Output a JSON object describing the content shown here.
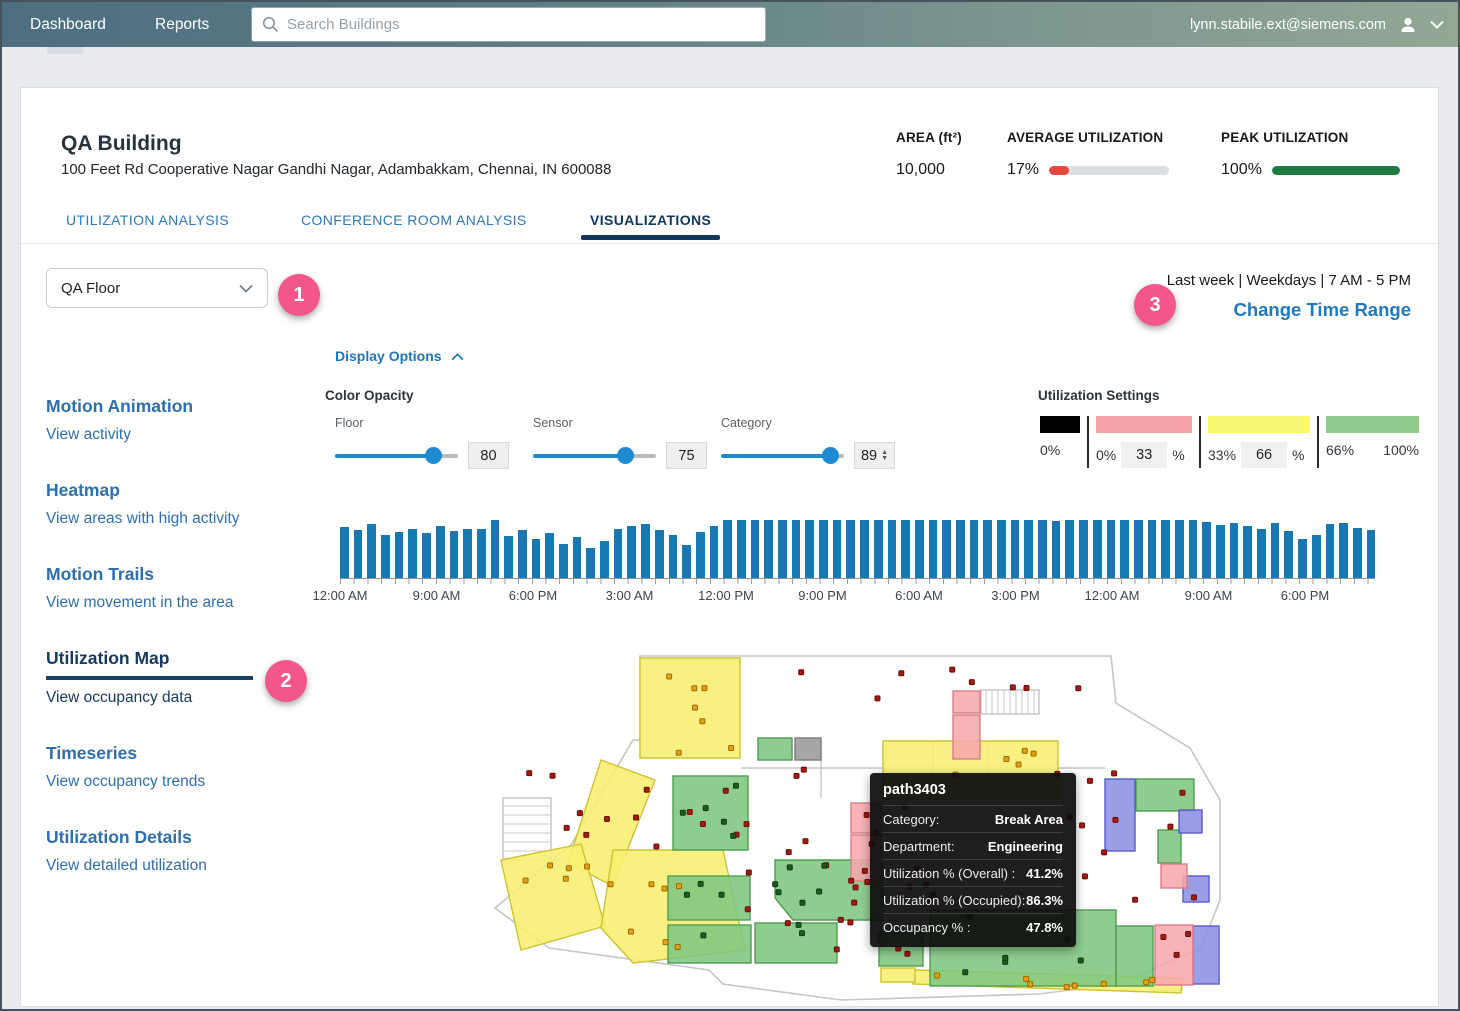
{
  "nav": {
    "dashboard": "Dashboard",
    "reports": "Reports",
    "search_placeholder": "Search Buildings",
    "user_email": "lynn.stabile.ext@siemens.com"
  },
  "header": {
    "building_name": "QA Building",
    "address": "100 Feet Rd Cooperative Nagar Gandhi Nagar, Adambakkam, Chennai, IN 600088",
    "stats": [
      {
        "label": "AREA (ft²)",
        "value": "10,000",
        "bar_pct": null,
        "bar_color": null
      },
      {
        "label": "AVERAGE UTILIZATION",
        "value": "17%",
        "bar_pct": 17,
        "bar_color": "#e2493f"
      },
      {
        "label": "PEAK UTILIZATION",
        "value": "100%",
        "bar_pct": 100,
        "bar_color": "#1e7c41"
      }
    ],
    "tabs": [
      {
        "label": "UTILIZATION ANALYSIS",
        "active": false
      },
      {
        "label": "CONFERENCE ROOM ANALYSIS",
        "active": false
      },
      {
        "label": "VISUALIZATIONS",
        "active": true
      }
    ]
  },
  "controls": {
    "floor_select_value": "QA Floor",
    "time_range_text": "Last week | Weekdays | 7 AM - 5 PM",
    "change_time_range_label": "Change Time Range",
    "display_options_label": "Display Options",
    "color_opacity_label": "Color Opacity",
    "sliders": [
      {
        "label": "Floor",
        "value": 80
      },
      {
        "label": "Sensor",
        "value": 75
      },
      {
        "label": "Category",
        "value": 89
      }
    ],
    "utilization_settings": {
      "title": "Utilization Settings",
      "segments": [
        {
          "swatch_color": "#000000",
          "swatch_w": 40,
          "start": "0%",
          "input": null,
          "suffix": null,
          "end": null
        },
        {
          "swatch_color": "#f5a2a8",
          "swatch_w": 96,
          "start": "0%",
          "input": "33",
          "suffix": "%",
          "end": null
        },
        {
          "swatch_color": "#f9f76f",
          "swatch_w": 102,
          "start": "33%",
          "input": "66",
          "suffix": "%",
          "end": null
        },
        {
          "swatch_color": "#8ecb8c",
          "swatch_w": 93,
          "start": "66%",
          "input": null,
          "suffix": null,
          "end": "100%"
        }
      ]
    }
  },
  "badges": {
    "one": "1",
    "two": "2",
    "three": "3"
  },
  "sidebar": {
    "items": [
      {
        "title": "Motion Animation",
        "subtitle": "View activity",
        "active": false
      },
      {
        "title": "Heatmap",
        "subtitle": "View areas with high activity",
        "active": false
      },
      {
        "title": "Motion Trails",
        "subtitle": "View movement in the area",
        "active": false
      },
      {
        "title": "Utilization Map",
        "subtitle": "View occupancy data",
        "active": true
      },
      {
        "title": "Timeseries",
        "subtitle": "View occupancy trends",
        "active": false
      },
      {
        "title": "Utilization Details",
        "subtitle": "View detailed utilization",
        "active": false
      }
    ]
  },
  "chart_data": {
    "type": "bar",
    "title": "Occupancy timeline brush",
    "xlabel": "",
    "ylabel": "",
    "ylim": [
      0,
      100
    ],
    "bar_color": "#1878b4",
    "x_tick_labels": [
      "12:00 AM",
      "9:00 AM",
      "6:00 PM",
      "3:00 AM",
      "12:00 PM",
      "9:00 PM",
      "6:00 AM",
      "3:00 PM",
      "12:00 AM",
      "9:00 AM",
      "6:00 PM"
    ],
    "values": [
      68,
      64,
      72,
      58,
      62,
      66,
      60,
      70,
      63,
      66,
      66,
      78,
      56,
      64,
      52,
      60,
      45,
      55,
      40,
      50,
      66,
      70,
      72,
      64,
      58,
      44,
      62,
      70,
      78,
      77,
      78,
      78,
      77,
      78,
      78,
      78,
      77,
      78,
      78,
      77,
      78,
      78,
      78,
      77,
      78,
      78,
      77,
      78,
      78,
      78,
      77,
      78,
      76,
      78,
      77,
      78,
      78,
      77,
      78,
      78,
      77,
      78,
      77,
      75,
      71,
      73,
      69,
      66,
      74,
      63,
      52,
      58,
      72,
      74,
      67,
      64
    ]
  },
  "floorplan": {
    "tooltip": {
      "title": "path3403",
      "rows": [
        {
          "label": "Category:",
          "value": "Break Area"
        },
        {
          "label": "Department:",
          "value": "Engineering"
        },
        {
          "label": "Utilization % (Overall) :",
          "value": "41.2%"
        },
        {
          "label": "Utilization % (Occupied):",
          "value": "86.3%"
        },
        {
          "label": "Occupancy % :",
          "value": "47.8%"
        }
      ]
    },
    "colors": {
      "yellow": {
        "fill": "#f7ef6f",
        "stroke": "#cdc331"
      },
      "green": {
        "fill": "#7ec67f",
        "stroke": "#4f9d53"
      },
      "blue": {
        "fill": "#8d90e3",
        "stroke": "#595cc9"
      },
      "pink": {
        "fill": "#f6a8ad",
        "stroke": "#d87f86"
      },
      "gray": {
        "fill": "#9b9b9b",
        "stroke": "#7a7a7a"
      }
    },
    "outline_path": "M150,92 L157,92 L157,8 L628,8 L633,55 L707,100 L737,152 L737,252 L718,300 L636,336 L556,346 L358,352 L240,336 L226,322 L66,300 L12,260 L88,197 Z",
    "wall_lines": [
      {
        "x1": 258,
        "y1": 120,
        "x2": 400,
        "y2": 120
      },
      {
        "x1": 575,
        "y1": 120,
        "x2": 622,
        "y2": 120
      },
      {
        "x1": 450,
        "y1": 93,
        "x2": 450,
        "y2": 150
      },
      {
        "x1": 505,
        "y1": 93,
        "x2": 505,
        "y2": 150
      },
      {
        "x1": 338,
        "y1": 90,
        "x2": 338,
        "y2": 150
      },
      {
        "x1": 398,
        "y1": 233,
        "x2": 398,
        "y2": 310
      }
    ],
    "stairs": [
      {
        "x": 498,
        "y": 42,
        "w": 58,
        "h": 24,
        "dir": "v"
      },
      {
        "x": 20,
        "y": 150,
        "w": 48,
        "h": 62,
        "dir": "h"
      }
    ],
    "rooms": [
      {
        "shape": "rect",
        "x": 157,
        "y": 10,
        "w": 100,
        "h": 100,
        "color": "yellow"
      },
      {
        "shape": "rect",
        "x": 400,
        "y": 93,
        "w": 175,
        "h": 58,
        "color": "yellow"
      },
      {
        "shape": "poly",
        "points": "118,112 172,132 130,238 85,215",
        "color": "yellow"
      },
      {
        "shape": "poly",
        "points": "18,212 98,196 122,278 38,302",
        "color": "yellow"
      },
      {
        "shape": "poly",
        "points": "130,202 240,202 262,302 150,315 118,280",
        "color": "yellow"
      },
      {
        "shape": "poly",
        "points": "432,322 700,330 698,345 430,336",
        "color": "yellow"
      },
      {
        "shape": "rect",
        "x": 398,
        "y": 320,
        "w": 34,
        "h": 14,
        "color": "yellow"
      },
      {
        "shape": "rect",
        "x": 275,
        "y": 90,
        "w": 34,
        "h": 22,
        "color": "green"
      },
      {
        "shape": "rect",
        "x": 190,
        "y": 128,
        "w": 75,
        "h": 74,
        "color": "green"
      },
      {
        "shape": "rect",
        "x": 185,
        "y": 228,
        "w": 82,
        "h": 44,
        "color": "green"
      },
      {
        "shape": "rect",
        "x": 185,
        "y": 277,
        "w": 83,
        "h": 38,
        "color": "green"
      },
      {
        "shape": "rect",
        "x": 272,
        "y": 275,
        "w": 82,
        "h": 40,
        "color": "green"
      },
      {
        "shape": "poly",
        "points": "292,212 400,212 400,272 310,272 292,250",
        "color": "green"
      },
      {
        "shape": "rect",
        "x": 447,
        "y": 262,
        "w": 186,
        "h": 76,
        "color": "green"
      },
      {
        "shape": "rect",
        "x": 633,
        "y": 278,
        "w": 37,
        "h": 60,
        "color": "green"
      },
      {
        "shape": "rect",
        "x": 653,
        "y": 131,
        "w": 58,
        "h": 32,
        "color": "green"
      },
      {
        "shape": "rect",
        "x": 675,
        "y": 182,
        "w": 23,
        "h": 33,
        "color": "green"
      },
      {
        "shape": "rect",
        "x": 396,
        "y": 284,
        "w": 44,
        "h": 34,
        "color": "green"
      },
      {
        "shape": "rect",
        "x": 622,
        "y": 131,
        "w": 30,
        "h": 72,
        "color": "blue"
      },
      {
        "shape": "rect",
        "x": 696,
        "y": 162,
        "w": 23,
        "h": 23,
        "color": "blue"
      },
      {
        "shape": "rect",
        "x": 700,
        "y": 228,
        "w": 26,
        "h": 26,
        "color": "blue"
      },
      {
        "shape": "rect",
        "x": 710,
        "y": 278,
        "w": 26,
        "h": 58,
        "color": "blue"
      },
      {
        "shape": "rect",
        "x": 368,
        "y": 155,
        "w": 30,
        "h": 30,
        "color": "pink"
      },
      {
        "shape": "rect",
        "x": 368,
        "y": 187,
        "w": 30,
        "h": 46,
        "color": "pink"
      },
      {
        "shape": "rect",
        "x": 470,
        "y": 43,
        "w": 27,
        "h": 22,
        "color": "pink"
      },
      {
        "shape": "rect",
        "x": 470,
        "y": 67,
        "w": 27,
        "h": 44,
        "color": "pink"
      },
      {
        "shape": "rect",
        "x": 672,
        "y": 277,
        "w": 38,
        "h": 60,
        "color": "pink"
      },
      {
        "shape": "rect",
        "x": 678,
        "y": 216,
        "w": 26,
        "h": 24,
        "color": "pink"
      },
      {
        "shape": "rect",
        "x": 312,
        "y": 90,
        "w": 26,
        "h": 22,
        "color": "gray"
      }
    ],
    "dot_zones": [
      {
        "x": 300,
        "y": 14,
        "w": 320,
        "h": 34,
        "n": 8,
        "type": "red"
      },
      {
        "x": 150,
        "y": 115,
        "w": 200,
        "h": 90,
        "n": 12,
        "type": "red"
      },
      {
        "x": 260,
        "y": 205,
        "w": 130,
        "h": 110,
        "n": 12,
        "type": "red"
      },
      {
        "x": 560,
        "y": 120,
        "w": 165,
        "h": 130,
        "n": 12,
        "type": "red"
      },
      {
        "x": 408,
        "y": 155,
        "w": 48,
        "h": 150,
        "n": 8,
        "type": "red"
      },
      {
        "x": 30,
        "y": 115,
        "w": 110,
        "h": 80,
        "n": 6,
        "type": "red"
      },
      {
        "x": 372,
        "y": 160,
        "w": 20,
        "h": 66,
        "n": 3,
        "type": "red"
      },
      {
        "x": 676,
        "y": 282,
        "w": 28,
        "h": 50,
        "n": 3,
        "type": "red"
      },
      {
        "x": 165,
        "y": 18,
        "w": 85,
        "h": 85,
        "n": 7,
        "type": "orange"
      },
      {
        "x": 28,
        "y": 212,
        "w": 215,
        "h": 90,
        "n": 12,
        "type": "orange"
      },
      {
        "x": 410,
        "y": 100,
        "w": 158,
        "h": 44,
        "n": 5,
        "type": "orange"
      },
      {
        "x": 438,
        "y": 324,
        "w": 250,
        "h": 14,
        "n": 8,
        "type": "orange"
      },
      {
        "x": 195,
        "y": 132,
        "w": 64,
        "h": 64,
        "n": 5,
        "type": "dgreen"
      },
      {
        "x": 190,
        "y": 232,
        "w": 150,
        "h": 75,
        "n": 8,
        "type": "dgreen"
      },
      {
        "x": 455,
        "y": 266,
        "w": 170,
        "h": 66,
        "n": 6,
        "type": "dgreen"
      },
      {
        "x": 300,
        "y": 215,
        "w": 95,
        "h": 50,
        "n": 4,
        "type": "dgreen"
      }
    ],
    "dot_colors": {
      "red": {
        "fill": "#a11b12",
        "stroke": "#6c0f09"
      },
      "orange": {
        "fill": "#e8a013",
        "stroke": "#9c6a05"
      },
      "dgreen": {
        "fill": "#1d5c20",
        "stroke": "#0f3d12"
      }
    }
  }
}
